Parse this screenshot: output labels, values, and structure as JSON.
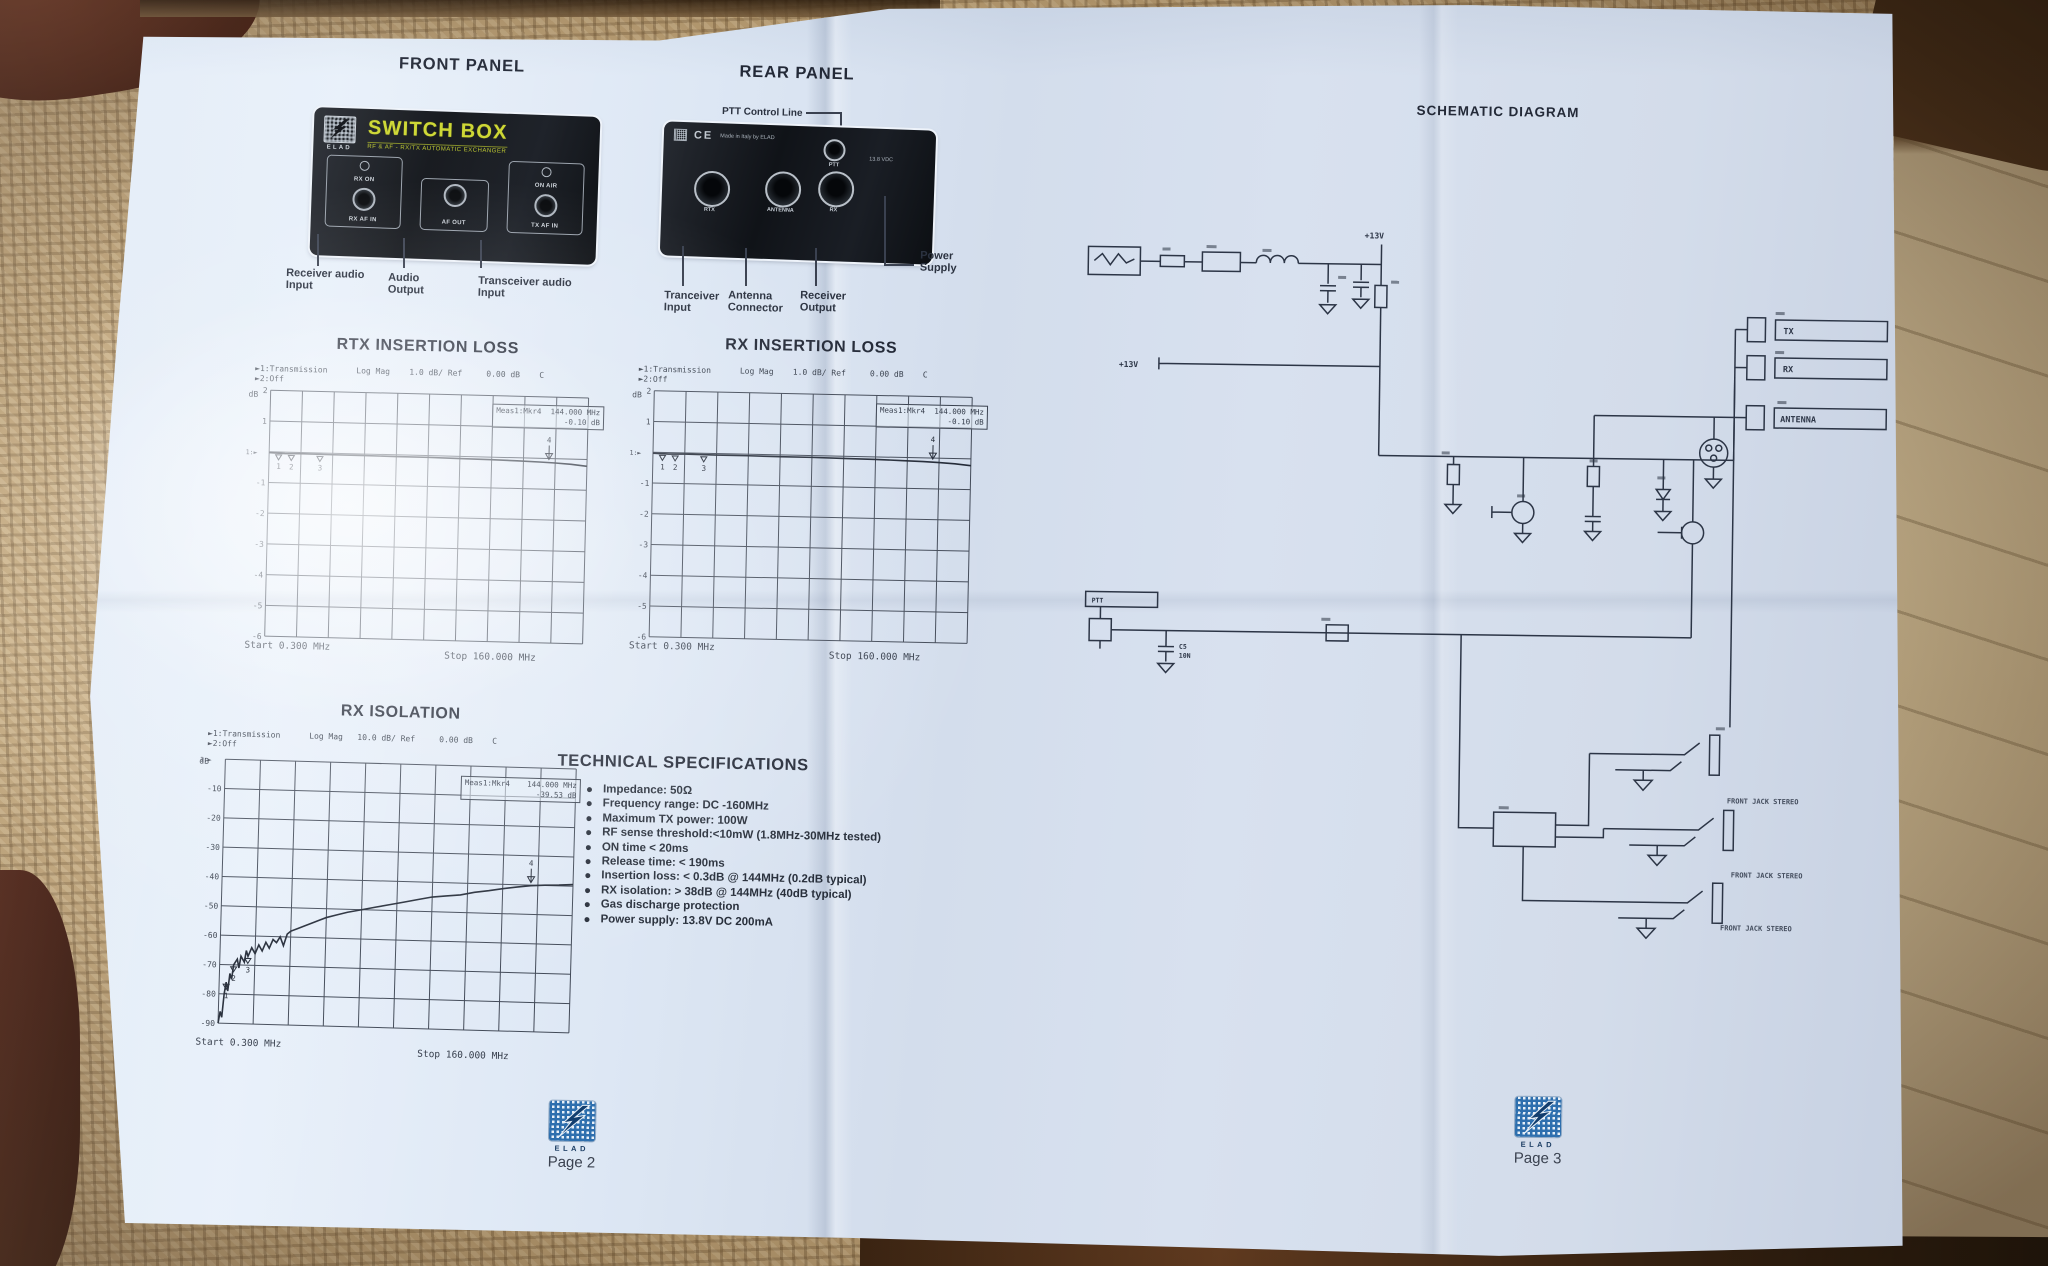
{
  "colors": {
    "paper": "#dde7f3",
    "ink": "#232a38",
    "panel_black": "#14171c",
    "brand_yellow": "#ccd62f",
    "logo_blue": "#2e6fae",
    "grid_line": "#424a58"
  },
  "page2": {
    "front_panel": {
      "heading": "FRONT PANEL",
      "brand": "ELAD",
      "product_name": "SWITCH BOX",
      "product_subtitle": "RF & AF - RX/TX AUTOMATIC EXCHANGER",
      "groups": [
        {
          "led": "RX ON",
          "jack": "RX AF IN"
        },
        {
          "led": "",
          "jack": "AF OUT"
        },
        {
          "led": "ON AIR",
          "jack": "TX AF IN"
        }
      ],
      "callouts": [
        {
          "l1": "Receiver audio",
          "l2": "Input"
        },
        {
          "l1": "Audio",
          "l2": "Output"
        },
        {
          "l1": "Transceiver audio",
          "l2": "Input"
        }
      ]
    },
    "rear_panel": {
      "heading": "REAR PANEL",
      "ptt_line_label": "PTT Control Line",
      "ce_mark": "CE",
      "made_in": "Made in Italy by ELAD",
      "supply_rating": "13.8 VDC",
      "ptt_label": "PTT",
      "connectors": [
        "RTX",
        "ANTENNA",
        "RX"
      ],
      "callouts": [
        {
          "l1": "Tranceiver",
          "l2": "Input"
        },
        {
          "l1": "Antenna",
          "l2": "Connector"
        },
        {
          "l1": "Receiver",
          "l2": "Output"
        },
        {
          "l1": "Power",
          "l2": "Supply"
        }
      ]
    },
    "specs": {
      "heading": "TECHNICAL SPECIFICATIONS",
      "items": [
        "Impedance: 50Ω",
        "Frequency range: DC -160MHz",
        "Maximum TX power: 100W",
        "RF sense threshold:<10mW (1.8MHz-30MHz tested)",
        "ON time < 20ms",
        "Release time: < 190ms",
        "Insertion loss: < 0.3dB @ 144MHz (0.2dB typical)",
        "RX isolation: > 38dB @ 144MHz (40dB  typical)",
        "Gas discharge protection",
        "Power supply: 13.8V DC 200mA"
      ]
    },
    "footer": {
      "brand": "ELAD",
      "page": "Page 2"
    }
  },
  "page3": {
    "heading": "SCHEMATIC DIAGRAM",
    "labels": {
      "rail": "+13V",
      "rail2": "+13V",
      "ptt": "PTT",
      "c5": "C5",
      "c5_val": "10N",
      "tx": "TX",
      "rx": "RX",
      "antenna": "ANTENNA",
      "jack1": "FRONT JACK STEREO",
      "jack2": "FRONT JACK STEREO",
      "jack3": "FRONT JACK STEREO"
    },
    "footer": {
      "brand": "ELAD",
      "page": "Page 3"
    }
  },
  "chart_data": [
    {
      "type": "line",
      "title": "RTX INSERTION LOSS",
      "header1": "►1:Transmission      Log Mag    1.0 dB/ Ref     0.00 dB    C",
      "header2": "►2:Off",
      "ylabel": "dB",
      "marker_name": "Meas1:Mkr4",
      "marker_freq": "144.000 MHz",
      "marker_value": "-0.10 dB",
      "start_label": "Start 0.300 MHz",
      "stop_label": "Stop 160.000 MHz",
      "x_start_mhz": 0.3,
      "x_stop_mhz": 160,
      "ydiv": 1.0,
      "ylim": [
        -6,
        2
      ],
      "yticks": [
        2,
        1,
        -1,
        -2,
        -3,
        -4,
        -5,
        -6
      ],
      "grid_cols": 10,
      "grid": true,
      "legend_position": "none",
      "trace": [
        [
          0,
          -0.03
        ],
        [
          5,
          -0.05
        ],
        [
          10,
          -0.04
        ],
        [
          20,
          -0.05
        ],
        [
          30,
          -0.05
        ],
        [
          40,
          -0.06
        ],
        [
          50,
          -0.06
        ],
        [
          60,
          -0.07
        ],
        [
          70,
          -0.08
        ],
        [
          78,
          -0.1
        ],
        [
          85,
          -0.12
        ],
        [
          90,
          -0.14
        ],
        [
          95,
          -0.17
        ],
        [
          100,
          -0.22
        ]
      ],
      "markers": [
        {
          "n": "1",
          "x": 3,
          "y": -0.03
        },
        {
          "n": "2",
          "x": 7,
          "y": -0.04
        },
        {
          "n": "3",
          "x": 16,
          "y": -0.05
        },
        {
          "n": "4",
          "x": 88,
          "y": -0.13,
          "arrow": true
        }
      ]
    },
    {
      "type": "line",
      "title": "RX INSERTION LOSS",
      "header1": "►1:Transmission      Log Mag    1.0 dB/ Ref     0.00 dB    C",
      "header2": "►2:Off",
      "ylabel": "dB",
      "marker_name": "Meas1:Mkr4",
      "marker_freq": "144.000 MHz",
      "marker_value": "-0.10 dB",
      "start_label": "Start 0.300 MHz",
      "stop_label": "Stop 160.000 MHz",
      "x_start_mhz": 0.3,
      "x_stop_mhz": 160,
      "ydiv": 1.0,
      "ylim": [
        -6,
        2
      ],
      "yticks": [
        2,
        1,
        -1,
        -2,
        -3,
        -4,
        -5,
        -6
      ],
      "grid_cols": 10,
      "grid": true,
      "legend_position": "none",
      "trace": [
        [
          0,
          -0.03
        ],
        [
          5,
          -0.05
        ],
        [
          10,
          -0.04
        ],
        [
          20,
          -0.05
        ],
        [
          30,
          -0.05
        ],
        [
          40,
          -0.06
        ],
        [
          50,
          -0.06
        ],
        [
          60,
          -0.07
        ],
        [
          70,
          -0.08
        ],
        [
          78,
          -0.1
        ],
        [
          85,
          -0.12
        ],
        [
          90,
          -0.14
        ],
        [
          95,
          -0.17
        ],
        [
          100,
          -0.22
        ]
      ],
      "markers": [
        {
          "n": "1",
          "x": 3,
          "y": -0.03
        },
        {
          "n": "2",
          "x": 7,
          "y": -0.04
        },
        {
          "n": "3",
          "x": 16,
          "y": -0.05
        },
        {
          "n": "4",
          "x": 88,
          "y": -0.13,
          "arrow": true
        }
      ]
    },
    {
      "type": "line",
      "title": "RX ISOLATION",
      "header1": "►1:Transmission      Log Mag   10.0 dB/ Ref     0.00 dB    C",
      "header2": "►2:Off",
      "ylabel": "dB",
      "marker_name": "Meas1:Mkr4",
      "marker_freq": "144.000 MHz",
      "marker_value": "-39.53 dB",
      "start_label": "Start 0.300 MHz",
      "stop_label": "Stop 160.000 MHz",
      "x_start_mhz": 0.3,
      "x_stop_mhz": 160,
      "ydiv": 10.0,
      "ylim": [
        -90,
        0
      ],
      "yticks": [
        -10,
        -20,
        -30,
        -40,
        -50,
        -60,
        -70,
        -80,
        -90
      ],
      "grid_cols": 10,
      "grid": true,
      "legend_position": "none",
      "trace": [
        [
          0,
          -90
        ],
        [
          0.5,
          -86
        ],
        [
          1,
          -88
        ],
        [
          1.5,
          -80
        ],
        [
          2,
          -76
        ],
        [
          2.5,
          -79
        ],
        [
          3,
          -73
        ],
        [
          3.5,
          -75
        ],
        [
          4,
          -70
        ],
        [
          5,
          -68
        ],
        [
          5.5,
          -71
        ],
        [
          6,
          -67
        ],
        [
          7,
          -69
        ],
        [
          7.5,
          -65
        ],
        [
          8,
          -67
        ],
        [
          9,
          -64
        ],
        [
          10,
          -66
        ],
        [
          11,
          -63
        ],
        [
          12,
          -65
        ],
        [
          13,
          -62
        ],
        [
          14,
          -64
        ],
        [
          15,
          -61
        ],
        [
          16,
          -62
        ],
        [
          17,
          -60
        ],
        [
          18,
          -63
        ],
        [
          19,
          -59
        ],
        [
          20,
          -58
        ],
        [
          22,
          -57
        ],
        [
          24,
          -56
        ],
        [
          26,
          -55
        ],
        [
          28,
          -54
        ],
        [
          30,
          -53
        ],
        [
          33,
          -52
        ],
        [
          36,
          -51
        ],
        [
          40,
          -50
        ],
        [
          44,
          -49
        ],
        [
          48,
          -48
        ],
        [
          52,
          -47
        ],
        [
          56,
          -46
        ],
        [
          60,
          -45
        ],
        [
          64,
          -44.5
        ],
        [
          68,
          -44
        ],
        [
          72,
          -43
        ],
        [
          76,
          -42.3
        ],
        [
          80,
          -41.5
        ],
        [
          84,
          -40.8
        ],
        [
          88,
          -40.2
        ],
        [
          92,
          -39.9
        ],
        [
          96,
          -39.7
        ],
        [
          100,
          -39.4
        ]
      ],
      "markers": [
        {
          "n": "1",
          "x": 2,
          "y": -76
        },
        {
          "n": "2",
          "x": 4,
          "y": -70
        },
        {
          "n": "3",
          "x": 8,
          "y": -67
        },
        {
          "n": "4",
          "x": 88,
          "y": -40.2,
          "arrow": true
        }
      ]
    }
  ]
}
